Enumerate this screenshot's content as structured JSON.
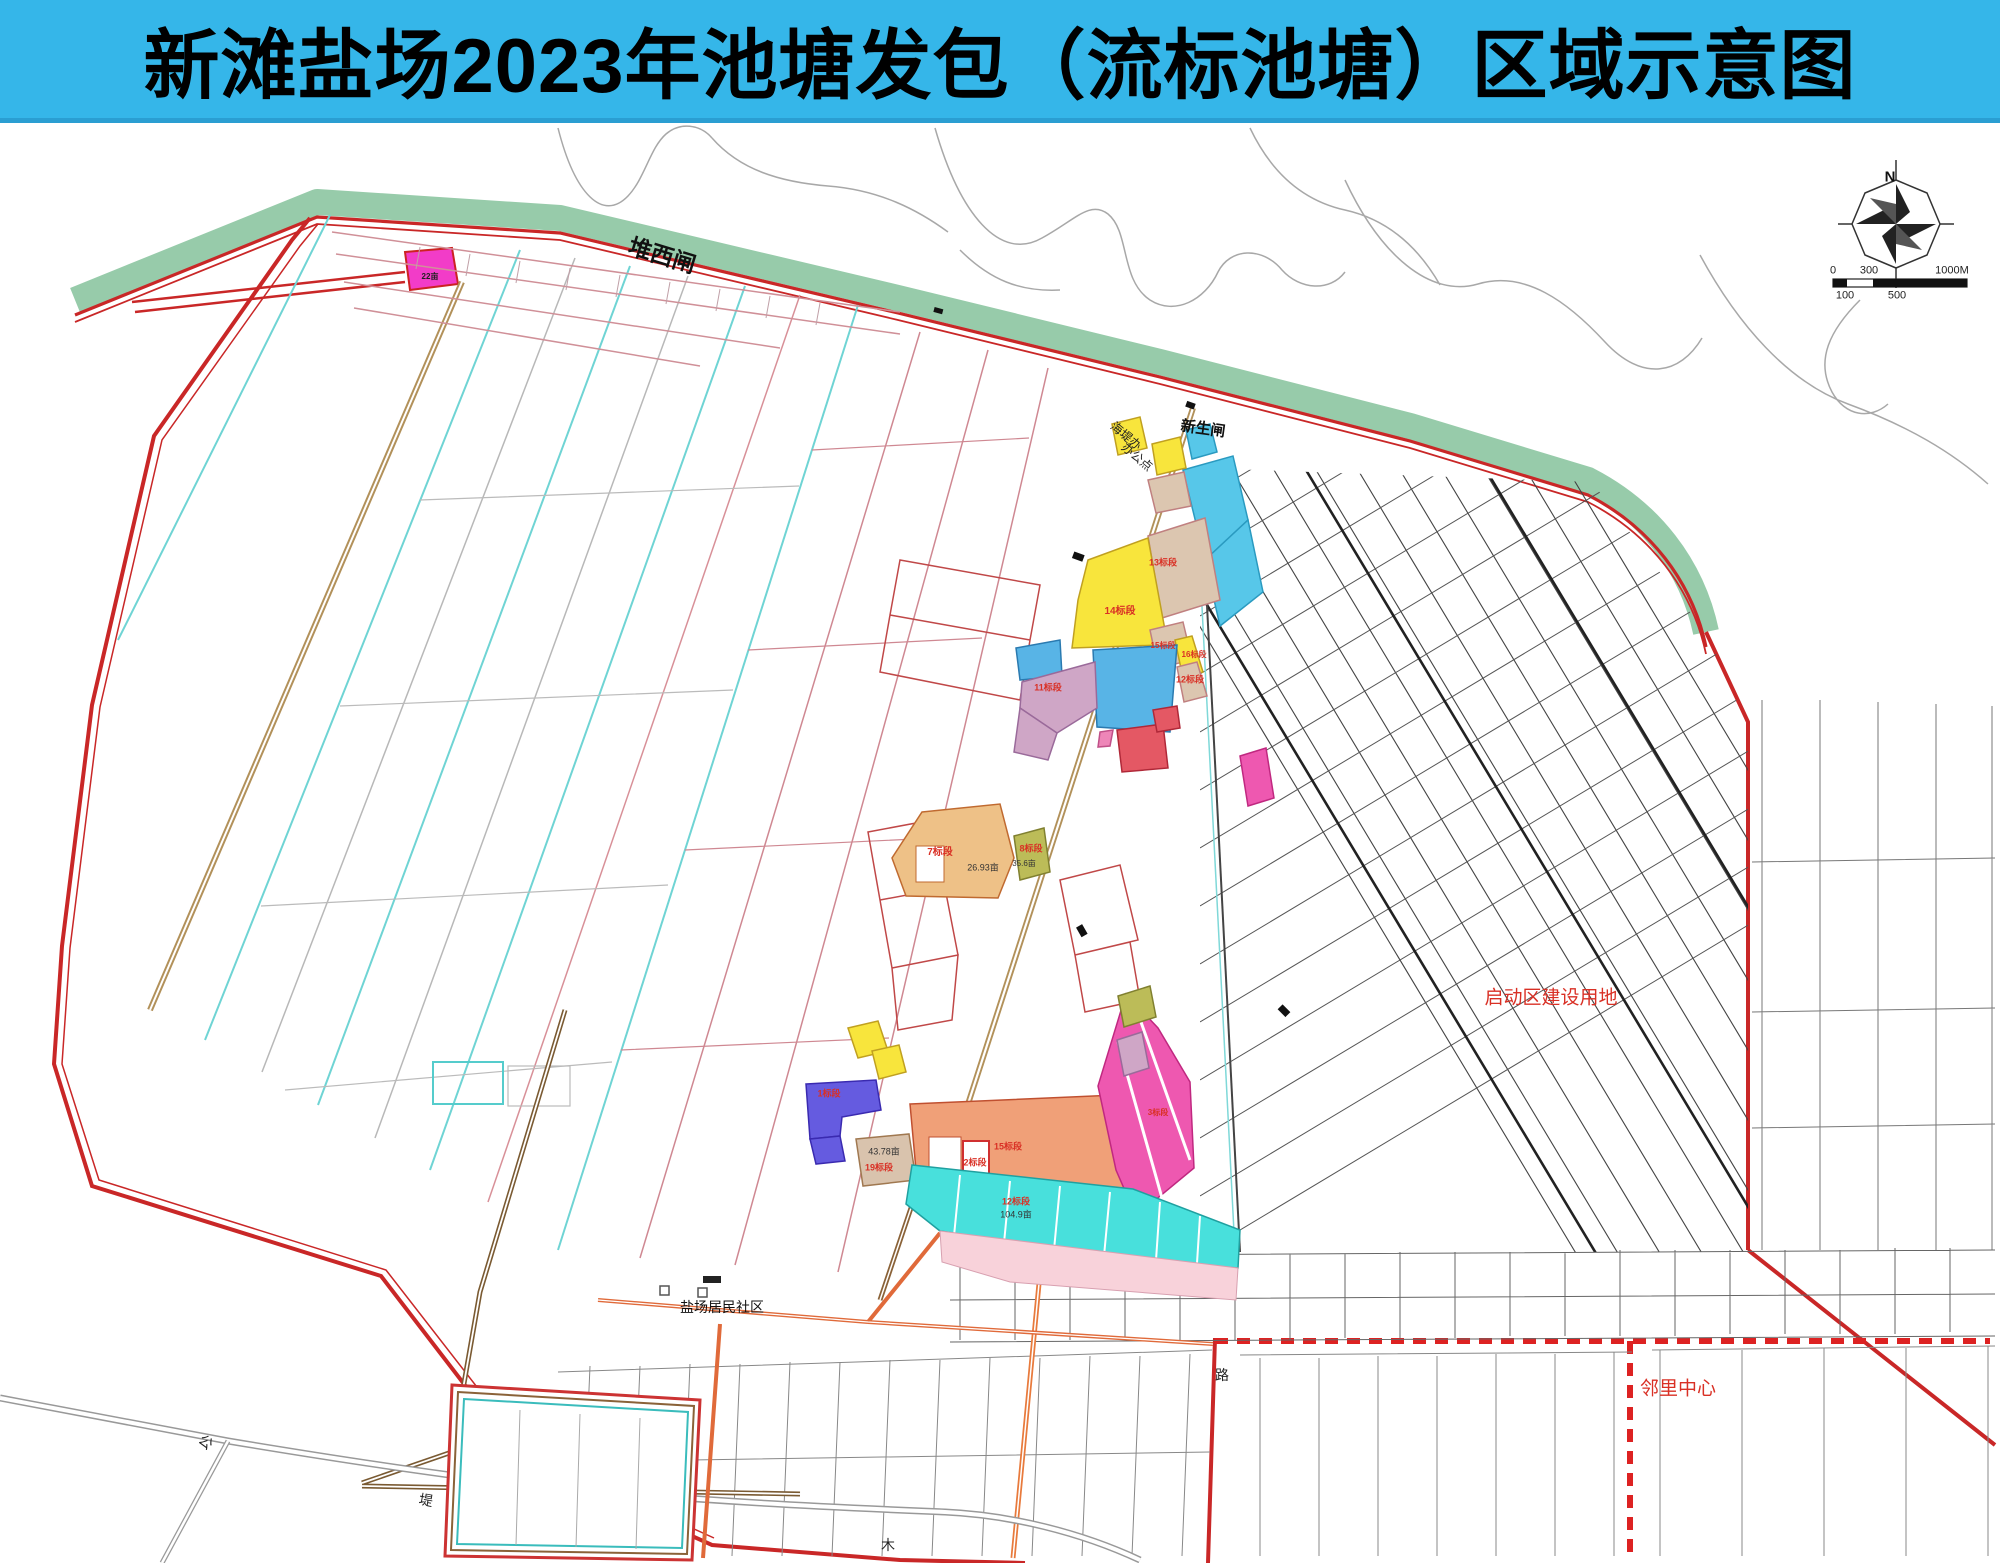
{
  "title": "新滩盐场2023年池塘发包（流标池塘）区域示意图",
  "colors": {
    "title_bar": "#35b6e9",
    "seawall_green": "#97cbaa",
    "boundary_red": "#c92727",
    "label_red": "#d93025",
    "pond_yellow": "#f8e53c",
    "pond_cyan": "#57c7e9",
    "pond_turquoise": "#48e0dc",
    "pond_blue": "#58b4e6",
    "pond_indigo": "#655be0",
    "pond_magenta": "#ee58b0",
    "pond_salmon": "#f0a078",
    "pond_tan": "#dcc6b0",
    "pond_mauve": "#cfa6c6",
    "pond_olive": "#bcbc58",
    "road_tan": "#b2915a",
    "road_orange": "#e87a3c"
  },
  "compass": {
    "name": "compass-north-label",
    "text": "N",
    "x": 1890,
    "y": 177,
    "size": 15,
    "weight": 700,
    "color": "#111111"
  },
  "scale_bar": {
    "labels": [
      {
        "name": "scale-label",
        "text": "0",
        "x": 1833,
        "y": 271,
        "size": 11,
        "color": "#222222"
      },
      {
        "name": "scale-label",
        "text": "300",
        "x": 1869,
        "y": 271,
        "size": 11,
        "color": "#222222"
      },
      {
        "name": "scale-label",
        "text": "1000M",
        "x": 1952,
        "y": 271,
        "size": 11,
        "color": "#222222"
      },
      {
        "name": "scale-label",
        "text": "100",
        "x": 1845,
        "y": 296,
        "size": 11,
        "color": "#222222"
      },
      {
        "name": "scale-label",
        "text": "500",
        "x": 1897,
        "y": 296,
        "size": 11,
        "color": "#222222"
      }
    ]
  },
  "map_labels": [
    {
      "name": "label-duixizha",
      "text": "堆西闸",
      "x": 662,
      "y": 256,
      "size": 23,
      "rot": 17,
      "color": "#111111",
      "weight": 700
    },
    {
      "name": "label-xinshengzha",
      "text": "新生闸",
      "x": 1203,
      "y": 429,
      "size": 15,
      "rot": 8,
      "color": "#111111",
      "weight": 700
    },
    {
      "name": "label-haidiban-line1",
      "text": "海堤办",
      "x": 1126,
      "y": 436,
      "size": 12,
      "rot": 40,
      "color": "#222222",
      "weight": 400
    },
    {
      "name": "label-haidiban-line2",
      "text": "办公点",
      "x": 1137,
      "y": 457,
      "size": 12,
      "rot": 40,
      "color": "#222222",
      "weight": 400
    },
    {
      "name": "label-saltworks-community",
      "text": "盐场居民社区",
      "x": 722,
      "y": 1307,
      "size": 14,
      "rot": 0,
      "color": "#111111",
      "weight": 400
    },
    {
      "name": "label-startup-zone",
      "text": "启动区建设用地",
      "x": 1551,
      "y": 998,
      "size": 19,
      "rot": 0,
      "color": "#d93025",
      "weight": 400
    },
    {
      "name": "label-neighborhood-center",
      "text": "邻里中心",
      "x": 1678,
      "y": 1389,
      "size": 19,
      "rot": 0,
      "color": "#d93025",
      "weight": 400
    },
    {
      "name": "label-road-gong",
      "text": "公",
      "x": 206,
      "y": 1442,
      "size": 14,
      "rot": 40,
      "color": "#222222",
      "weight": 400
    },
    {
      "name": "label-road-di",
      "text": "堤",
      "x": 426,
      "y": 1500,
      "size": 14,
      "rot": 10,
      "color": "#222222",
      "weight": 400
    },
    {
      "name": "label-road-lu",
      "text": "路",
      "x": 1222,
      "y": 1375,
      "size": 14,
      "rot": 0,
      "color": "#222222",
      "weight": 400
    },
    {
      "name": "label-road-mu",
      "text": "木",
      "x": 888,
      "y": 1545,
      "size": 14,
      "rot": 0,
      "color": "#222222",
      "weight": 400
    }
  ],
  "parcel_labels": [
    {
      "name": "parcel-area-label",
      "text": "22亩",
      "x": 430,
      "y": 277,
      "size": 8,
      "color": "#222222",
      "weight": 700
    },
    {
      "name": "parcel-bid-label",
      "text": "13标段",
      "x": 1163,
      "y": 563,
      "size": 9,
      "color": "#d93025",
      "weight": 700
    },
    {
      "name": "parcel-bid-label",
      "text": "14标段",
      "x": 1120,
      "y": 612,
      "size": 10,
      "color": "#d93025",
      "weight": 700
    },
    {
      "name": "parcel-bid-label",
      "text": "15标段",
      "x": 1163,
      "y": 646,
      "size": 8,
      "color": "#d93025",
      "weight": 700
    },
    {
      "name": "parcel-bid-label",
      "text": "16标段",
      "x": 1194,
      "y": 655,
      "size": 8,
      "color": "#d93025",
      "weight": 700
    },
    {
      "name": "parcel-bid-label",
      "text": "12标段",
      "x": 1190,
      "y": 680,
      "size": 9,
      "color": "#d93025",
      "weight": 700
    },
    {
      "name": "parcel-bid-label",
      "text": "11标段",
      "x": 1048,
      "y": 688,
      "size": 9,
      "color": "#d93025",
      "weight": 700
    },
    {
      "name": "parcel-bid-label",
      "text": "7标段",
      "x": 940,
      "y": 853,
      "size": 10,
      "color": "#d93025",
      "weight": 700
    },
    {
      "name": "parcel-bid-label",
      "text": "8标段",
      "x": 1031,
      "y": 849,
      "size": 9,
      "color": "#d93025",
      "weight": 700
    },
    {
      "name": "parcel-area-label",
      "text": "35.6亩",
      "x": 1024,
      "y": 864,
      "size": 8,
      "color": "#333333",
      "weight": 400
    },
    {
      "name": "parcel-area-label",
      "text": "26.93亩",
      "x": 983,
      "y": 868,
      "size": 9,
      "color": "#333333",
      "weight": 400
    },
    {
      "name": "parcel-bid-label",
      "text": "1标段",
      "x": 829,
      "y": 1094,
      "size": 9,
      "color": "#d93025",
      "weight": 700
    },
    {
      "name": "parcel-area-label",
      "text": "43.78亩",
      "x": 884,
      "y": 1152,
      "size": 9,
      "color": "#333333",
      "weight": 400
    },
    {
      "name": "parcel-bid-label",
      "text": "19标段",
      "x": 879,
      "y": 1168,
      "size": 9,
      "color": "#d93025",
      "weight": 700
    },
    {
      "name": "parcel-bid-label",
      "text": "2标段",
      "x": 975,
      "y": 1163,
      "size": 9,
      "color": "#d93025",
      "weight": 700
    },
    {
      "name": "parcel-bid-label",
      "text": "15标段",
      "x": 1008,
      "y": 1147,
      "size": 9,
      "color": "#d93025",
      "weight": 700
    },
    {
      "name": "parcel-bid-label",
      "text": "3标段",
      "x": 1158,
      "y": 1113,
      "size": 8,
      "color": "#d93025",
      "weight": 700
    },
    {
      "name": "parcel-bid-label",
      "text": "12标段",
      "x": 1016,
      "y": 1202,
      "size": 9,
      "color": "#d93025",
      "weight": 700
    },
    {
      "name": "parcel-area-label",
      "text": "104.9亩",
      "x": 1016,
      "y": 1215,
      "size": 9,
      "color": "#333333",
      "weight": 400
    }
  ]
}
